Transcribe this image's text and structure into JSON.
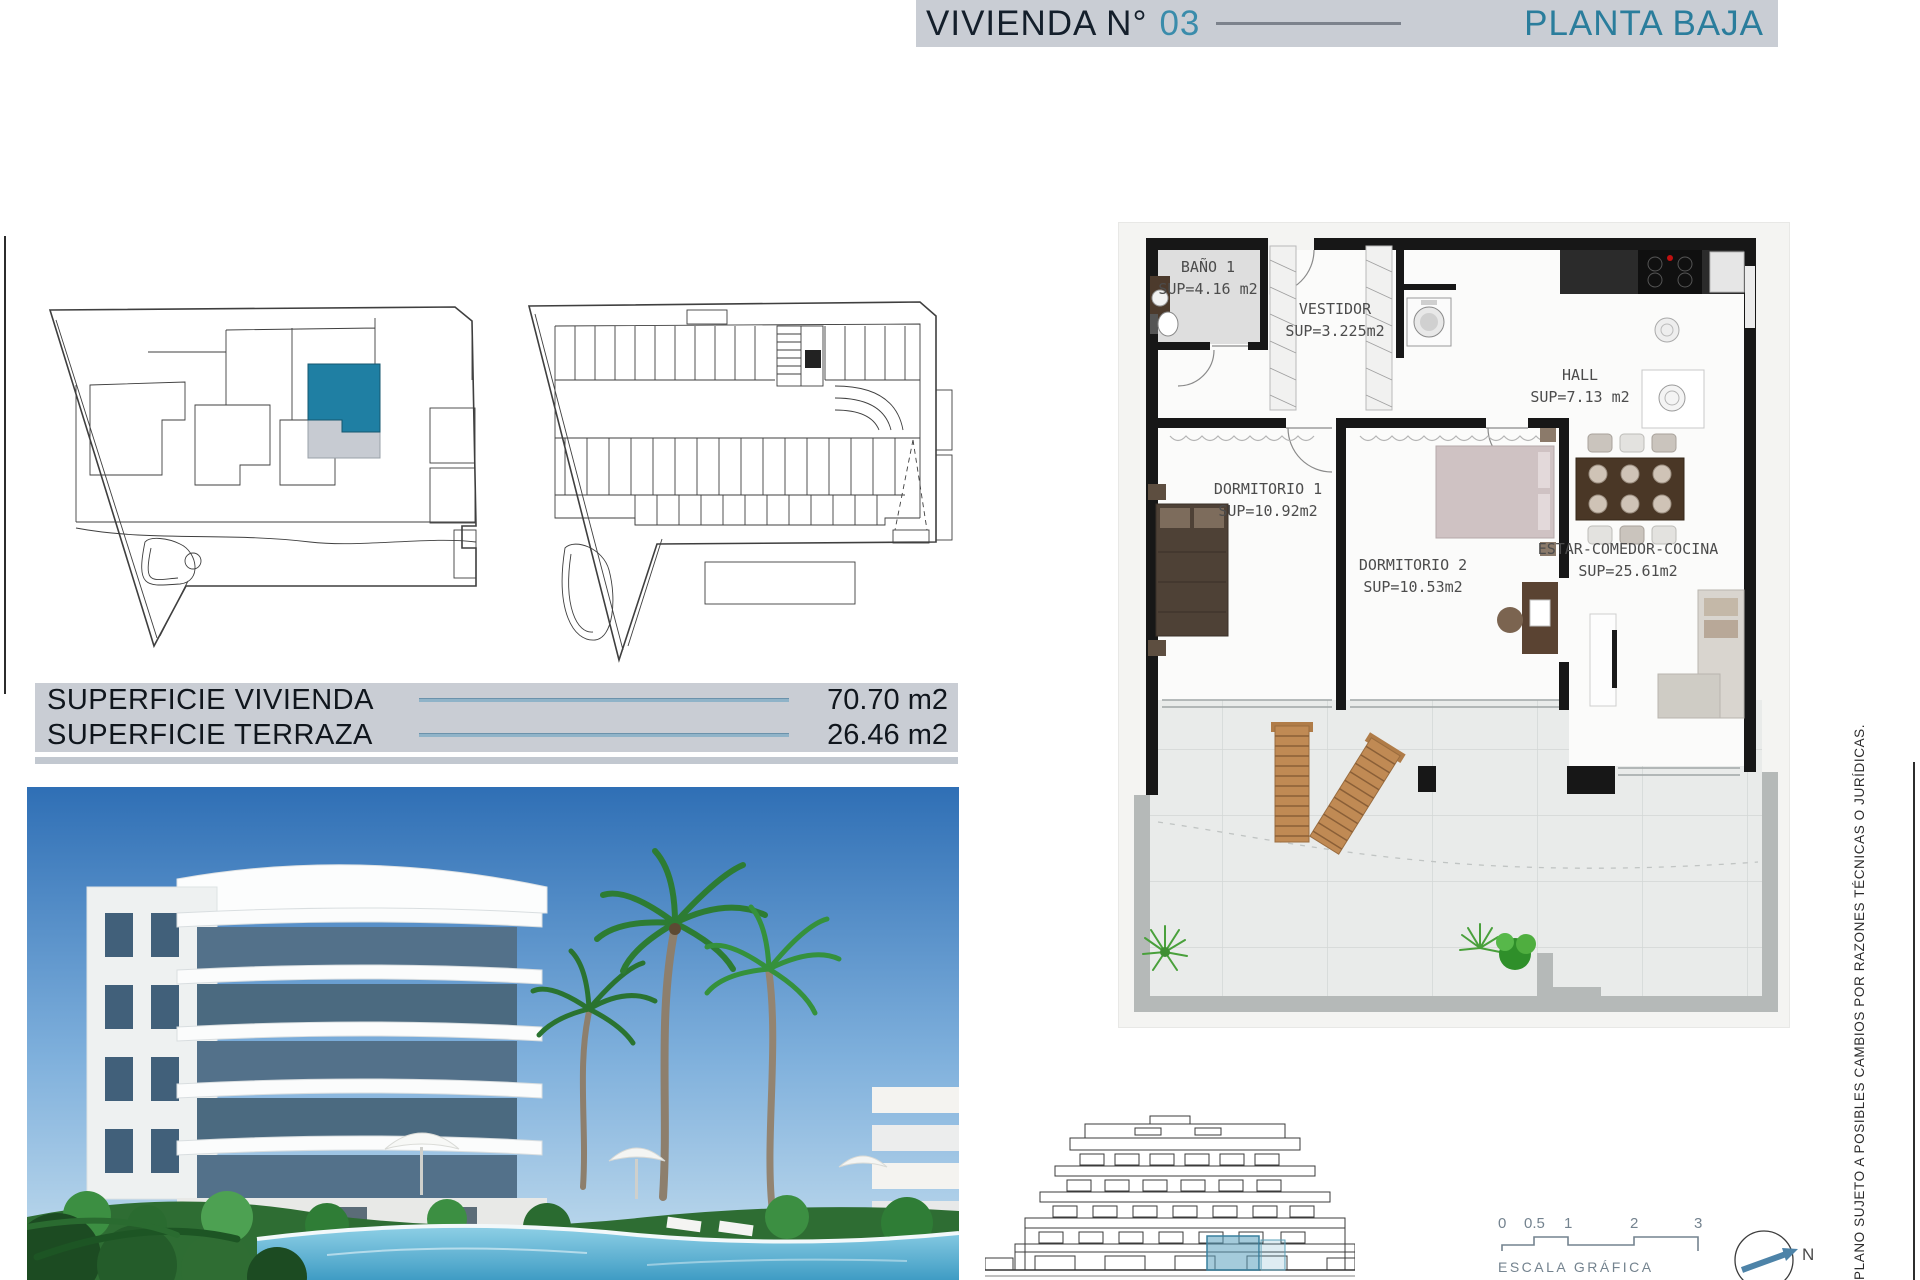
{
  "header": {
    "title": "VIVIENDA N°",
    "unit_number": "03",
    "floor_label": "PLANTA BAJA"
  },
  "surface_table": {
    "rows": [
      {
        "label": "SUPERFICIE VIVIENDA",
        "value": "70.70 m2"
      },
      {
        "label": "SUPERFICIE TERRAZA",
        "value": "26.46 m2"
      }
    ]
  },
  "floor_plan": {
    "rooms": [
      {
        "name": "BAÑO 1",
        "area": "SUP=4.16 m2"
      },
      {
        "name": "VESTIDOR",
        "area": "SUP=3.225m2"
      },
      {
        "name": "HALL",
        "area": "SUP=7.13 m2"
      },
      {
        "name": "DORMITORIO 1",
        "area": "SUP=10.92m2"
      },
      {
        "name": "DORMITORIO 2",
        "area": "SUP=10.53m2"
      },
      {
        "name": "ESTAR-COMEDOR-COCINA",
        "area": "SUP=25.61m2"
      }
    ]
  },
  "scale_bar": {
    "label": "ESCALA GRÁFICA",
    "ticks": [
      "0",
      "0.5",
      "1",
      "2",
      "3"
    ]
  },
  "compass": {
    "north_label": "N"
  },
  "disclaimer": "PLANO SUJETO A POSIBLES CAMBIOS POR RAZONES TÉCNICAS O JURÍDICAS.",
  "colors": {
    "accent_teal": "#2a7d9c",
    "header_navy": "#141f2b",
    "bar_gray": "#c9cdd4",
    "highlight_unit": "#1f7fa3",
    "elevation_highlight": "#5aa0be"
  }
}
